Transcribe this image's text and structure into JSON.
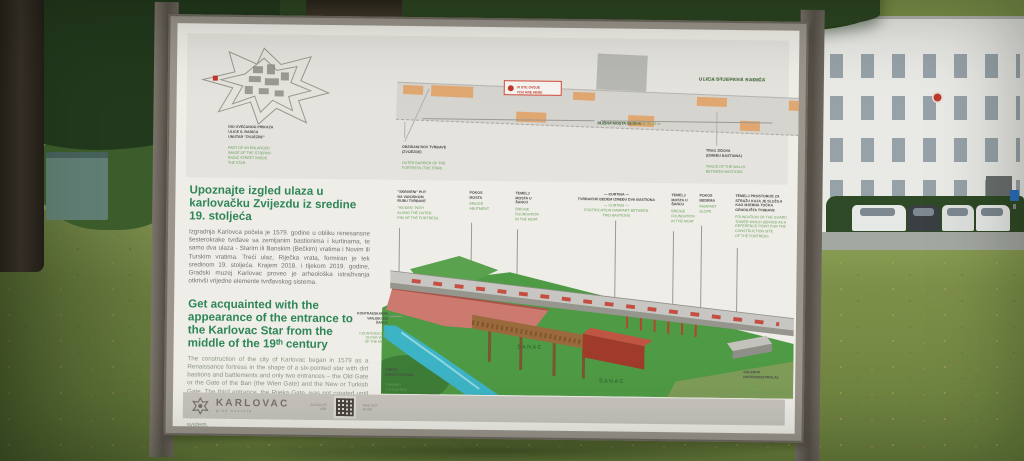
{
  "colors": {
    "title_green": "#2e8657",
    "label_green": "#67a05b",
    "accent_red": "#c0392b",
    "plan_orange": "#e2a265"
  },
  "board": {
    "plan": {
      "street_hr": "ULICA STJEPANA RADIĆA",
      "street_en": " • STJEPAN RADIĆ STREET",
      "you_here_hr": "VI STE OVDJE",
      "you_here_en": "YOU ARE HERE",
      "star_caption_hr": "DIO UVEĆANOG PRIKAZA\nULICE S. RADIĆA\nUNUTAR \"ZVIJEZDE\"",
      "star_caption_en": "PART OF AN ENLARGED\nIMAGE OF THE STJEPAN\nRADIĆ STREET INSIDE\nTHE STAR",
      "moat_hr": "OBZIDANI ROV TVRĐAVE\n(ZVIJEZDE)",
      "moat_en": "OUTER BARRIER OF THE\nFORTRESS (THE STAR)",
      "length_hr": "DUŽINA MOSTA 33,10 m",
      "length_en": " • LENGTH OF THE BRIDGE 33,10 m",
      "walls_hr": "TRAG ZIDOVA\n(IZMEĐU BASTIONA)",
      "walls_en": "TRACE OF THE WALLS\nBETWEEN BASTIONS"
    },
    "intro": {
      "hr_title": "Upoznajte izgled ulaza u karlovačku Zvijezdu iz sredine 19. stoljeća",
      "hr_body": "Izgradnja Karlovca počela je 1579. godine u obliku renesansne šesterokrake tvrđave sa zemljanim bastionima i kurtinama, te samo dva ulaza - Starim ili Banskim (Bečkim) vratima i Novim ili Turskim vratima. Treći ulaz, Riječka vrata, formiran je tek sredinom 19. stoljeća. Krajem 2018. i tijekom 2019. godine, Gradski muzej Karlovac proveo je arheološka istraživanja otkrivši vrijedne elemente tvrđavskog sistema.",
      "en_title": "Get acquainted with the appearance of the entrance to the Karlovac Star from the middle of the 19ᵗʰ century",
      "en_body": "The construction of the city of Karlovac began in 1579 as a Renaissance fortress in the shape of a six-pointed star with dirt bastions and battlements and only two entrances – the Old Gate or the Gate of the Ban (the Wien Gate) and the New or Turkish Gate. The third entrance, the Rijeka Gate, was not created until the middle of the 19ᵗʰ century. At the end of 2018 and during 2019, the City Museum of Karlovac conducted archaeological research and discovered valuable elements of the fortress system."
    },
    "callouts": [
      {
        "hr": "\"SKRIVENI\" PUT\nNA VANJSKOM\nRUBU TVRĐAVE",
        "en": "\"HIDDEN\" PATH\nALONG THE OUTER\nRIM OF THE FORTRESS"
      },
      {
        "hr": "POKOS\nMOSTA",
        "en": "BRIDGE\nABUTMENT"
      },
      {
        "hr": "TEMELJ\nMOSTA U\nŠANCU",
        "en": "BRIDGE\nFOUNDATION\nIN THE MOAT"
      },
      {
        "hr": "— KURTINA —\nTVRĐAVSKI BEDEM IZMEĐU DVA BASTIONA",
        "en": "— CURTAIN —\nFORTIFICATION RAMPART BETWEEN\nTWO BASTIONS"
      },
      {
        "hr": "TEMELJ\nMOSTA U\nŠANCU",
        "en": "BRIDGE\nFOUNDATION\nIN THE MOAT"
      },
      {
        "hr": "POKOS\nBEDEMA",
        "en": "RAMPART\nSLOPE"
      },
      {
        "hr": "TEMELJ PROSTORIJE ZA\nSTRAŽU KOJA JE SLUŽILA\nKAO MJERNA TOČKA\nGRADILIŠTA TVRĐAVE",
        "en": "FOUNDATION OF THE GUARD\nTOWER WHICH SERVED AS A\nREFERENCE POINT FOR THE\nCONSTRUCTION SITE\nOF THE FORTRESS"
      }
    ],
    "illus_labels": {
      "kontra_hr": "KONTRAESKARPA\nVANJSKI ZID\nŠANCA",
      "kontra_en": "COUNTERSCARP\nOUTER WALL\nOF THE MOAT",
      "kineta_hr": "KINETA\nKORITO POTOKA",
      "kineta_en": "CHANNEL\nSTREAM BED",
      "galerija_hr": "GALERIJA\nNATKRIVENI PROLAZ",
      "galerija_en": "GALLERY\nCOVERED PASSAGE",
      "sanac1": "ŠANAC",
      "sanac2": "ŠANAC"
    },
    "footer": {
      "brand": "KARLOVAC",
      "tagline": "grad susreta",
      "qr_left": "SAZNAJTE\nVIŠE",
      "qr_right": "FIND OUT\nMORE"
    }
  }
}
